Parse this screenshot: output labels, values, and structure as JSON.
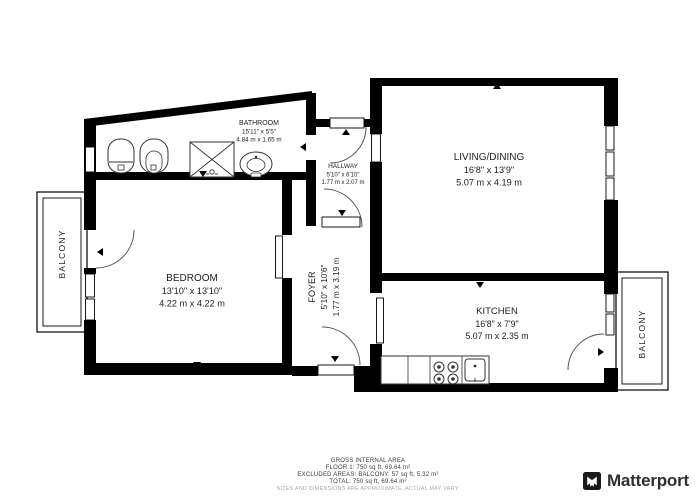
{
  "rooms": {
    "bathroom": {
      "name": "BATHROOM",
      "imperial": "15'11\" x 5'5\"",
      "metric": "4.84 m x 1.65 m"
    },
    "hallway": {
      "name": "HALLWAY",
      "imperial": "5'10\" x 6'10\"",
      "metric": "1.77 m x 2.07 m"
    },
    "living": {
      "name": "LIVING/DINING",
      "imperial": "16'8\" x 13'9\"",
      "metric": "5.07 m x 4.19 m"
    },
    "bedroom": {
      "name": "BEDROOM",
      "imperial": "13'10\" x 13'10\"",
      "metric": "4.22 m x 4.22 m"
    },
    "foyer": {
      "name": "FOYER",
      "imperial": "5'10\" x 10'6\"",
      "metric": "1.77 m x 3.19 m"
    },
    "kitchen": {
      "name": "KITCHEN",
      "imperial": "16'8\" x 7'9\"",
      "metric": "5.07 m x 2.35 m"
    },
    "balcony_left": {
      "name": "BALCONY"
    },
    "balcony_right": {
      "name": "BALCONY"
    }
  },
  "footer": {
    "title": "GROSS INTERNAL AREA",
    "floor": "FLOOR 1: 750 sq ft, 69.64 m²",
    "excluded": "EXCLUDED AREAS: BALCONY: 57 sq ft, 5.32 m²",
    "total": "TOTAL: 750 sq ft, 69.64 m²",
    "disclaimer": "SIZES AND DIMENSIONS ARE APPROXIMATE, ACTUAL MAY VARY."
  },
  "brand": {
    "name": "Matterport"
  },
  "colors": {
    "wall": "#000000",
    "background": "#ffffff",
    "text": "#1f1f1f",
    "disclaimer": "#a9a9a9"
  }
}
